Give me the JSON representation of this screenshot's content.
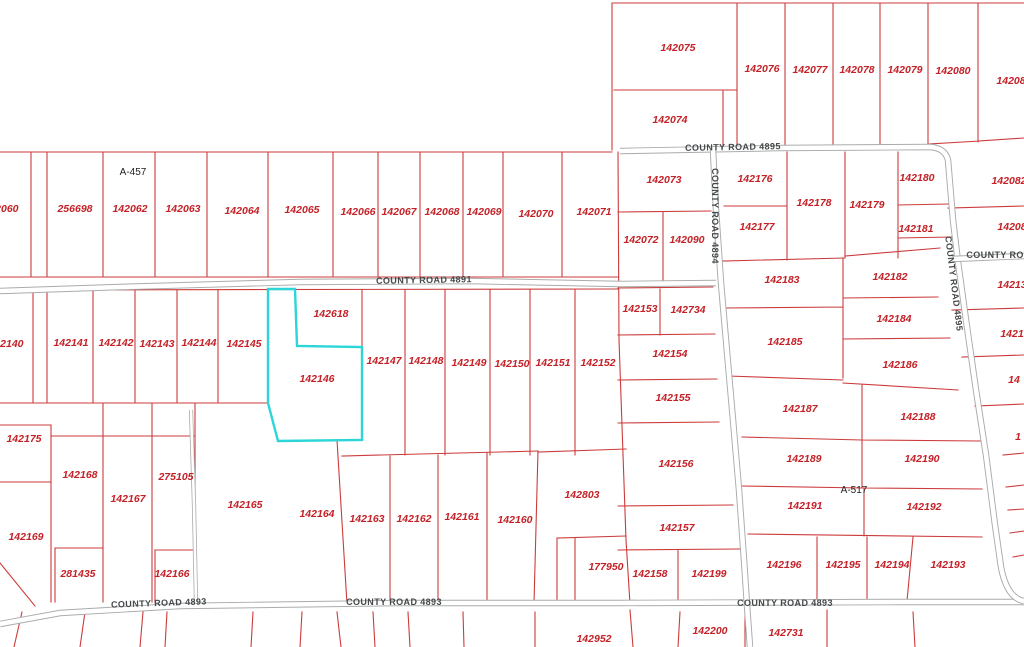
{
  "map": {
    "type": "parcel-map",
    "highlighted_parcel_id": "142146",
    "colors": {
      "background": "#ffffff",
      "parcel_line": "#cc3b3b",
      "parcel_label": "#c42127",
      "highlight": "#2bd5d8",
      "road_casing": "#a9acab",
      "road_fill": "#ffffff",
      "road_label": "#44484a",
      "survey_label": "#1f1f1f"
    },
    "survey_labels": [
      {
        "t": "A-457",
        "x": 133,
        "y": 175
      },
      {
        "t": "A-517",
        "x": 854,
        "y": 493
      }
    ],
    "road_labels": [
      {
        "t": "COUNTY ROAD 4891",
        "x": 424,
        "y": 283,
        "a": -1
      },
      {
        "t": "COUNTY ROAD 4895",
        "x": 733,
        "y": 150,
        "a": -1
      },
      {
        "t": "COUNTY ROAD 4894",
        "x": 712,
        "y": 216,
        "a": 90
      },
      {
        "t": "COUNTY ROAD 4895",
        "x": 951,
        "y": 284,
        "a": 83
      },
      {
        "t": "COUNTY ROAD",
        "x": 1002,
        "y": 258,
        "a": 0
      },
      {
        "t": "COUNTY ROAD 4893",
        "x": 159,
        "y": 606,
        "a": -2
      },
      {
        "t": "COUNTY ROAD 4893",
        "x": 394,
        "y": 605,
        "a": 0
      },
      {
        "t": "COUNTY ROAD 4893",
        "x": 785,
        "y": 606,
        "a": 0
      }
    ],
    "parcel_labels": [
      {
        "t": "142060",
        "x": 1,
        "y": 212
      },
      {
        "t": "256698",
        "x": 75,
        "y": 212
      },
      {
        "t": "142062",
        "x": 130,
        "y": 212
      },
      {
        "t": "142063",
        "x": 183,
        "y": 212
      },
      {
        "t": "142064",
        "x": 242,
        "y": 214
      },
      {
        "t": "142065",
        "x": 302,
        "y": 213
      },
      {
        "t": "142066",
        "x": 358,
        "y": 215
      },
      {
        "t": "142067",
        "x": 399,
        "y": 215
      },
      {
        "t": "142068",
        "x": 442,
        "y": 215
      },
      {
        "t": "142069",
        "x": 484,
        "y": 215
      },
      {
        "t": "142070",
        "x": 536,
        "y": 217
      },
      {
        "t": "142071",
        "x": 594,
        "y": 215
      },
      {
        "t": "142140",
        "x": 6,
        "y": 347
      },
      {
        "t": "142141",
        "x": 71,
        "y": 346
      },
      {
        "t": "142142",
        "x": 116,
        "y": 346
      },
      {
        "t": "142143",
        "x": 157,
        "y": 347
      },
      {
        "t": "142144",
        "x": 199,
        "y": 346
      },
      {
        "t": "142145",
        "x": 244,
        "y": 347
      },
      {
        "t": "142618",
        "x": 331,
        "y": 317
      },
      {
        "t": "142146",
        "x": 317,
        "y": 382
      },
      {
        "t": "142147",
        "x": 384,
        "y": 364
      },
      {
        "t": "142148",
        "x": 426,
        "y": 364
      },
      {
        "t": "142149",
        "x": 469,
        "y": 366
      },
      {
        "t": "142150",
        "x": 512,
        "y": 367
      },
      {
        "t": "142151",
        "x": 553,
        "y": 366
      },
      {
        "t": "142152",
        "x": 598,
        "y": 366
      },
      {
        "t": "142175",
        "x": 24,
        "y": 442
      },
      {
        "t": "142168",
        "x": 80,
        "y": 478
      },
      {
        "t": "275105",
        "x": 176,
        "y": 480
      },
      {
        "t": "142167",
        "x": 128,
        "y": 502
      },
      {
        "t": "142169",
        "x": 26,
        "y": 540
      },
      {
        "t": "281435",
        "x": 78,
        "y": 577
      },
      {
        "t": "142166",
        "x": 172,
        "y": 577
      },
      {
        "t": "142165",
        "x": 245,
        "y": 508
      },
      {
        "t": "142164",
        "x": 317,
        "y": 517
      },
      {
        "t": "142163",
        "x": 367,
        "y": 522
      },
      {
        "t": "142162",
        "x": 414,
        "y": 522
      },
      {
        "t": "142161",
        "x": 462,
        "y": 520
      },
      {
        "t": "142160",
        "x": 515,
        "y": 523
      },
      {
        "t": "142803",
        "x": 582,
        "y": 498
      },
      {
        "t": "177950",
        "x": 606,
        "y": 570
      },
      {
        "t": "142952",
        "x": 594,
        "y": 642
      },
      {
        "t": "142075",
        "x": 678,
        "y": 51
      },
      {
        "t": "142076",
        "x": 762,
        "y": 72
      },
      {
        "t": "142077",
        "x": 810,
        "y": 73
      },
      {
        "t": "142078",
        "x": 857,
        "y": 73
      },
      {
        "t": "142079",
        "x": 905,
        "y": 73
      },
      {
        "t": "142080",
        "x": 953,
        "y": 74
      },
      {
        "t": "14208",
        "x": 1011,
        "y": 84
      },
      {
        "t": "142074",
        "x": 670,
        "y": 123
      },
      {
        "t": "142073",
        "x": 664,
        "y": 183
      },
      {
        "t": "142072",
        "x": 641,
        "y": 243
      },
      {
        "t": "142090",
        "x": 687,
        "y": 243
      },
      {
        "t": "142153",
        "x": 640,
        "y": 312
      },
      {
        "t": "142734",
        "x": 688,
        "y": 313
      },
      {
        "t": "142154",
        "x": 670,
        "y": 357
      },
      {
        "t": "142155",
        "x": 673,
        "y": 401
      },
      {
        "t": "142156",
        "x": 676,
        "y": 467
      },
      {
        "t": "142157",
        "x": 677,
        "y": 531
      },
      {
        "t": "142158",
        "x": 650,
        "y": 577
      },
      {
        "t": "142199",
        "x": 709,
        "y": 577
      },
      {
        "t": "142176",
        "x": 755,
        "y": 182
      },
      {
        "t": "142177",
        "x": 757,
        "y": 230
      },
      {
        "t": "142178",
        "x": 814,
        "y": 206
      },
      {
        "t": "142179",
        "x": 867,
        "y": 208
      },
      {
        "t": "142180",
        "x": 917,
        "y": 181
      },
      {
        "t": "142181",
        "x": 916,
        "y": 232
      },
      {
        "t": "142183",
        "x": 782,
        "y": 283
      },
      {
        "t": "142182",
        "x": 890,
        "y": 280
      },
      {
        "t": "142184",
        "x": 894,
        "y": 322
      },
      {
        "t": "142185",
        "x": 785,
        "y": 345
      },
      {
        "t": "142186",
        "x": 900,
        "y": 368
      },
      {
        "t": "142187",
        "x": 800,
        "y": 412
      },
      {
        "t": "142188",
        "x": 918,
        "y": 420
      },
      {
        "t": "142189",
        "x": 804,
        "y": 462
      },
      {
        "t": "142190",
        "x": 922,
        "y": 462
      },
      {
        "t": "142191",
        "x": 805,
        "y": 509
      },
      {
        "t": "142192",
        "x": 924,
        "y": 510
      },
      {
        "t": "142196",
        "x": 784,
        "y": 568
      },
      {
        "t": "142195",
        "x": 843,
        "y": 568
      },
      {
        "t": "142194",
        "x": 892,
        "y": 568
      },
      {
        "t": "142193",
        "x": 948,
        "y": 568
      },
      {
        "t": "142200",
        "x": 710,
        "y": 634
      },
      {
        "t": "142731",
        "x": 786,
        "y": 636
      },
      {
        "t": "142082",
        "x": 1009,
        "y": 184
      },
      {
        "t": "14208",
        "x": 1012,
        "y": 230
      },
      {
        "t": "14213",
        "x": 1012,
        "y": 288
      },
      {
        "t": "1421",
        "x": 1012,
        "y": 337
      },
      {
        "t": "14",
        "x": 1014,
        "y": 383
      },
      {
        "t": "1",
        "x": 1018,
        "y": 440
      }
    ]
  }
}
